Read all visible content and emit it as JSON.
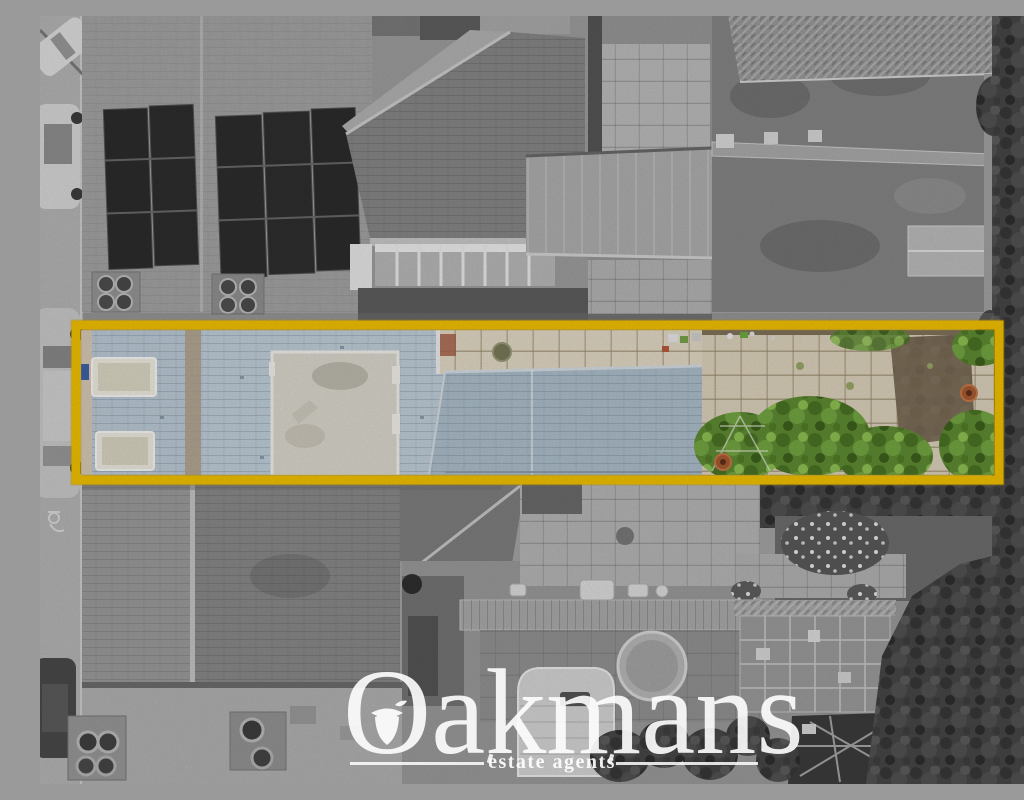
{
  "image": {
    "type": "aerial-photograph",
    "description": "Bird's-eye drone photo of a terraced street; surroundings desaturated to grayscale while the listed property strip (house roofs, patio and rear garden) is shown in colour inside a thick yellow highlight rectangle.",
    "watermark": {
      "brand": "Oakmans",
      "tagline": "estate agents"
    },
    "colors": {
      "highlight": "#F3C200",
      "watermark": "#FFFFFF",
      "roof-slate-blue": "#BCCBD7",
      "rear-roof-blue": "#AEBFCC",
      "paving-cream": "#E0D6C0",
      "garden-green": "#5F8C33",
      "terracotta": "#A85A32"
    },
    "features": [
      "parked-cars",
      "solar-panels",
      "chimney-pots",
      "terraced-roofs",
      "rear-gardens",
      "highlighted-property-strip",
      "white-dormer-roof",
      "skylights",
      "caravan",
      "greenhouse",
      "garden-trees"
    ]
  }
}
